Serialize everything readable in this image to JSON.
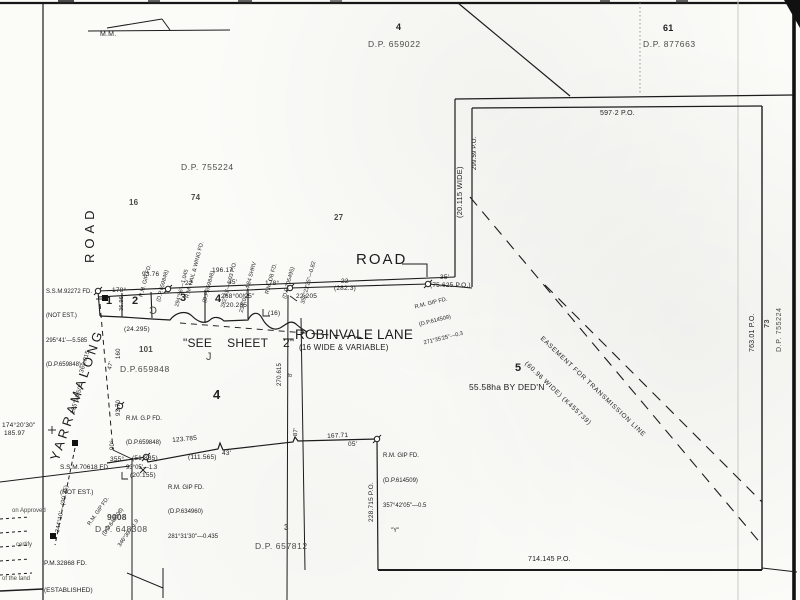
{
  "colors": {
    "paper": "#fbfbf8",
    "ink": "#1c1c1c",
    "faint": "#b9b9b4"
  },
  "labels": {
    "mm_top": "M.M.",
    "mm_bottom": "",
    "lot4_adj": "4",
    "dp659022": "D.P. 659022",
    "lot61_adj": "61",
    "dp877663": "D.P. 877663",
    "m597_2": "597·2 P.O.",
    "wide_20115": "(20.115 WIDE)",
    "m299_59": "299.59 P.O.",
    "dp755224_top": "D.P. 755224",
    "lot16_adj": "16",
    "lot74_adj": "74",
    "lot27_adj": "27",
    "road_label": "ROAD",
    "m93_76": "93.76",
    "m196_17": "196.17",
    "m22_a": "22",
    "m35_a": "35'",
    "m178_a": "178°",
    "m178_b": "178°",
    "m22_b": "22",
    "m282_3": "(282.3)",
    "m35_b": "35'",
    "m75_625": "(75.625 P.O.)",
    "lot1": "1",
    "lot2": "2",
    "lot3": "3",
    "lot4_small": "4",
    "m268_00_25": "268°00'25\"",
    "m20_285": "20.285",
    "m22_205": "22.205",
    "m16_lane": "(16)",
    "m36_96": "36.96",
    "m24_295": "(24.295)",
    "lot101": "101",
    "dp659848_mid": "D.P.659848",
    "see_sheet": "\"SEE  SHEET  2\"",
    "robinvale": "ROBINVALE LANE",
    "robinvale_sub": "(16 WIDE & VARIABLE)",
    "lot4_big": "4",
    "m270_615": "270.615",
    "m8ft": "8'",
    "yarramalong": "YARRAMALONG",
    "yarra_road": "ROAD",
    "m369_015": "369.015",
    "m135_10_50": "135°10'50\"",
    "m47": "47'",
    "m160": "160",
    "m93_70": "93.70",
    "m90": "90°",
    "m174_20_30": "174°20'30\"",
    "m185_97": "185.97",
    "m355": "355°",
    "m51_835": "(51.835)",
    "m20_155": "(20.155)",
    "m344_10": "344°10'—(90.35)",
    "m123_785": "123.785",
    "m43": "43'",
    "m111_565": "(111.565)",
    "m87": "87'",
    "m167_71": "167.71",
    "m05": "05'",
    "m228_715": "228.715 P.O.",
    "lot9008": "9008",
    "dp648308": "D.P. 648308",
    "lot3_adj": "3",
    "dp657812": "D.P. 657812",
    "lot5": "5",
    "lot5_area": "55.58ha BY DED'N",
    "m714_145": "714.145 P.O.",
    "m763_01": "763.01 P.O.",
    "lot73_adj": "73",
    "dp755224_right": "D.P. 755224",
    "brace_j": "J",
    "brace_c": "C"
  },
  "blocks": {
    "ssm92272": [
      "S.S.M.92272 FD.",
      "(NOT EST.)",
      "295°41'—5.585",
      "(D.P.659848)"
    ],
    "rm_gip_659848": [
      "R.M. GIP FD.",
      "(D.P.659848)",
      "294°56'—1.045"
    ],
    "rm_nail_wing": [
      "R.M. NAIL & WING FD.",
      "(D.P.659848)",
      "282°41'—1.03 P.O.",
      "234°02'—4.84 SHRV"
    ],
    "rm_db": [
      "R.M. DB FD.",
      "(D.P.705495)",
      "358°22'25\"—0.82"
    ],
    "rm_gip_614509_road": [
      "R.M. GIP FD.",
      "(D.P.614509)",
      "271°35'25\"—0.3"
    ],
    "rm_gp_659848": [
      "R.M. G.P FD.",
      "(D.P.659848)",
      "93°05'—1.3"
    ],
    "ssm70618": [
      "S.S.M.70618 FD.",
      "(NOT EST.)"
    ],
    "rm_gip_648308": [
      "R.M. GIP FD.",
      "(D.P.648308)",
      "346°39'—1.9"
    ],
    "rm_gip_634960": [
      "R.M. GIP FD.",
      "(D.P.634960)",
      "281°31'30\"—0.435"
    ],
    "rm_gip_614509_y": [
      "R.M. GIP FD.",
      "(D.P.614509)",
      "357°42'05\"—0.5",
      "\"Y\""
    ],
    "pm32868": [
      "P.M.32868 FD.",
      "(ESTABLISHED)"
    ],
    "easement": [
      "EASEMENT FOR TRANSMISSION LINE",
      "(60.96 WIDE) (K455739)"
    ],
    "form": [
      "on Approved",
      "certify",
      "of the land"
    ]
  }
}
